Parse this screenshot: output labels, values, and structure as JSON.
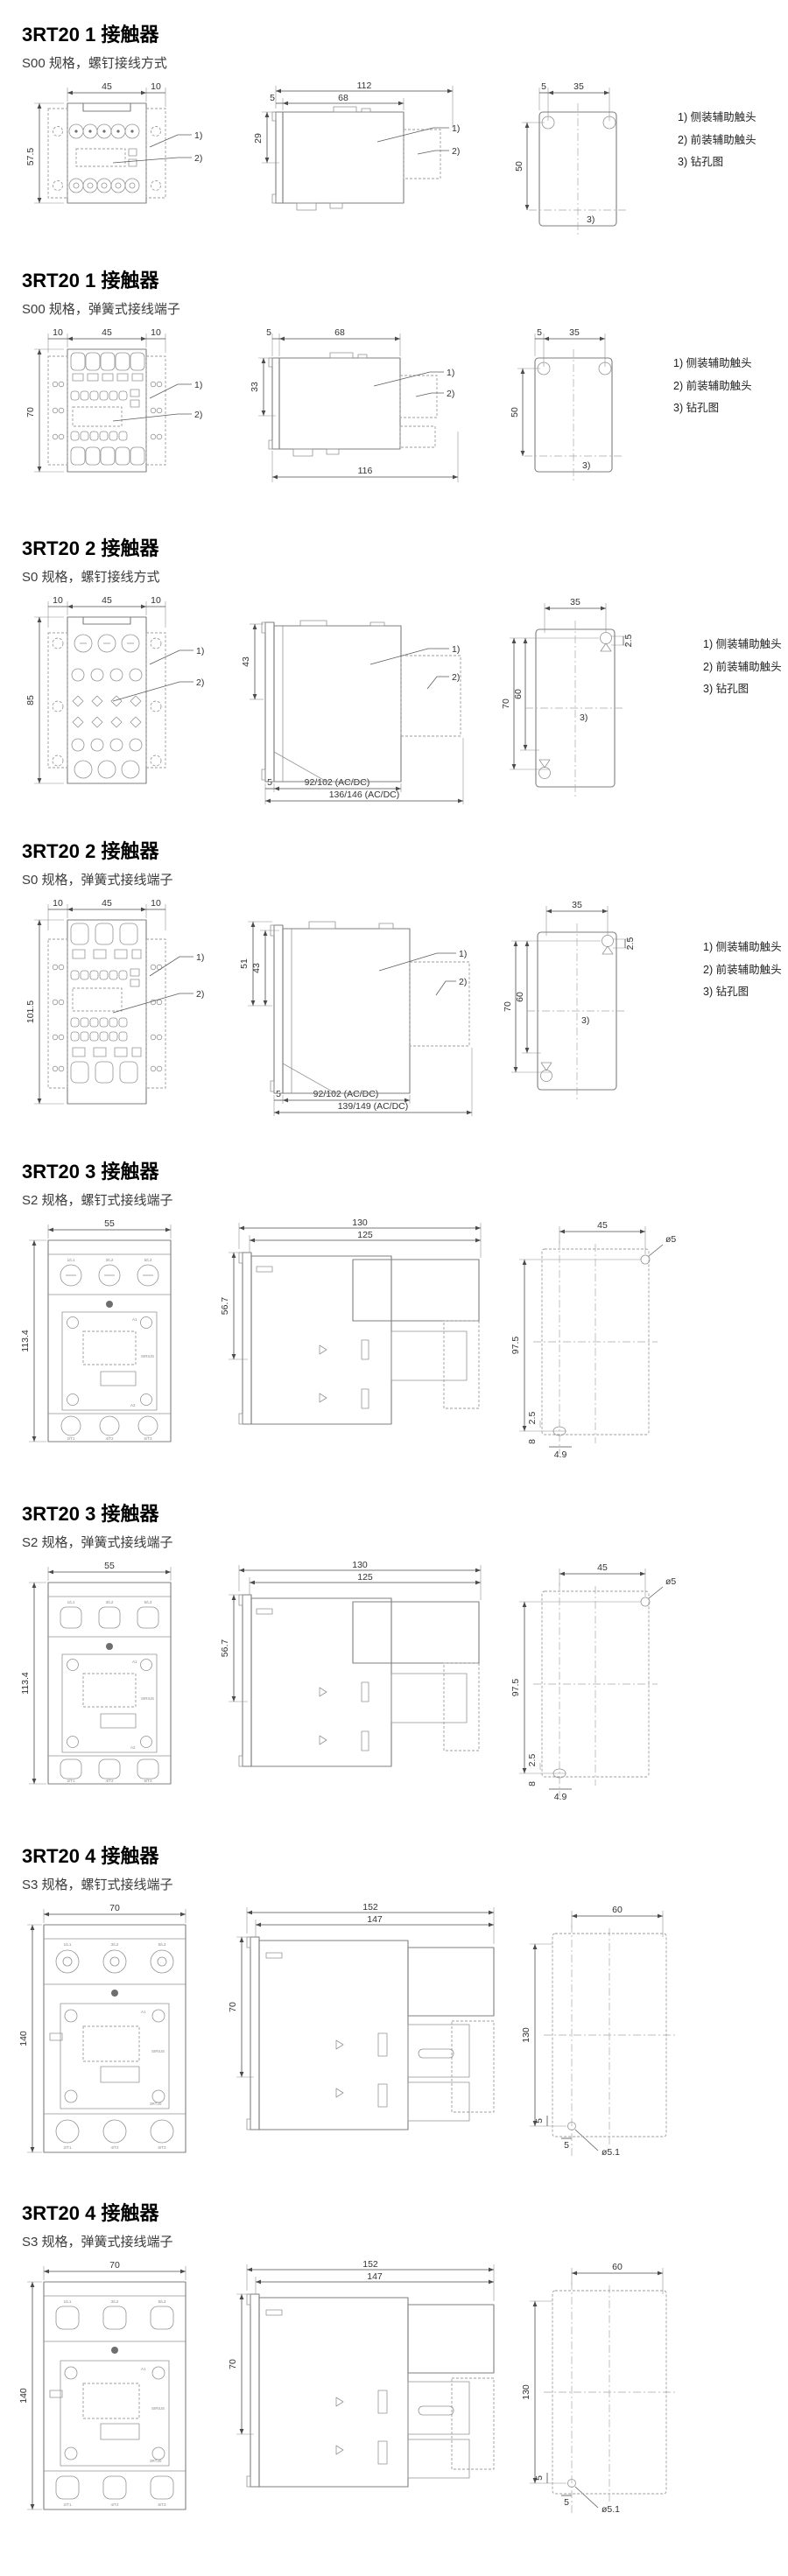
{
  "callouts": {
    "c1": "1)",
    "c2": "2)",
    "c3": "3)"
  },
  "notes": [
    "1) 侧装辅助触头",
    "2) 前装辅助触头",
    "3) 钻孔图"
  ],
  "terminals": {
    "t1": "1/L1",
    "t2": "3/L2",
    "t3": "5/L3",
    "b1": "2/T1",
    "b2": "4/T2",
    "b3": "6/T3",
    "a1": "A1",
    "a2": "A2",
    "brand": "SIRIUS",
    "model": "3RT20"
  },
  "sections": [
    {
      "title": "3RT20 1 接触器",
      "subtitle": "S00 规格，螺钉接线方式",
      "front": {
        "w": "45",
        "wr": "10",
        "h": "57.5"
      },
      "side": {
        "total": "112",
        "body": "68",
        "off": "5",
        "h": "29"
      },
      "drill": {
        "off": "5",
        "w": "35",
        "h": "50"
      }
    },
    {
      "title": "3RT20 1 接触器",
      "subtitle": "S00 规格，弹簧式接线端子",
      "front": {
        "wl": "10",
        "w": "45",
        "wr": "10",
        "h": "70"
      },
      "side": {
        "off": "5",
        "body": "68",
        "h": "33",
        "total": "116"
      },
      "drill": {
        "off": "5",
        "w": "35",
        "h": "50"
      }
    },
    {
      "title": "3RT20 2 接触器",
      "subtitle": "S0 规格，螺钉接线方式",
      "front": {
        "wl": "10",
        "w": "45",
        "wr": "10",
        "h": "85"
      },
      "side": {
        "h": "43",
        "off": "5",
        "d1": "92/102 (AC/DC)",
        "d2": "136/146 (AC/DC)"
      },
      "drill": {
        "w": "35",
        "off": "2.5",
        "h1": "70",
        "h2": "60"
      }
    },
    {
      "title": "3RT20 2 接触器",
      "subtitle": "S0 规格，弹簧式接线端子",
      "front": {
        "wl": "10",
        "w": "45",
        "wr": "10",
        "h": "101.5"
      },
      "side": {
        "h1": "51",
        "h2": "43",
        "off": "5",
        "d1": "92/102 (AC/DC)",
        "d2": "139/149 (AC/DC)"
      },
      "drill": {
        "w": "35",
        "off": "2.5",
        "h1": "70",
        "h2": "60"
      }
    },
    {
      "title": "3RT20 3 接触器",
      "subtitle": "S2 规格，螺钉式接线端子",
      "front": {
        "w": "55",
        "h": "113.4"
      },
      "side": {
        "total": "130",
        "body": "125",
        "h": "56.7"
      },
      "drill": {
        "w": "45",
        "hole": "ø5",
        "h": "97.5",
        "o1": "2.5",
        "o2": "8",
        "o3": "4.9"
      }
    },
    {
      "title": "3RT20 3 接触器",
      "subtitle": "S2 规格，弹簧式接线端子",
      "front": {
        "w": "55",
        "h": "113.4"
      },
      "side": {
        "total": "130",
        "body": "125",
        "h": "56.7"
      },
      "drill": {
        "w": "45",
        "hole": "ø5",
        "h": "97.5",
        "o1": "2.5",
        "o2": "8",
        "o3": "4.9"
      }
    },
    {
      "title": "3RT20 4 接触器",
      "subtitle": "S3 规格，螺钉式接线端子",
      "front": {
        "w": "70",
        "h": "140"
      },
      "side": {
        "total": "152",
        "body": "147",
        "h": "70"
      },
      "drill": {
        "w": "60",
        "h": "130",
        "o1": "5",
        "o2": "5",
        "hole": "ø5.1"
      }
    },
    {
      "title": "3RT20 4 接触器",
      "subtitle": "S3 规格，弹簧式接线端子",
      "front": {
        "w": "70",
        "h": "140"
      },
      "side": {
        "total": "152",
        "body": "147",
        "h": "70"
      },
      "drill": {
        "w": "60",
        "h": "130",
        "o1": "5",
        "o2": "5",
        "hole": "ø5.1"
      }
    }
  ]
}
